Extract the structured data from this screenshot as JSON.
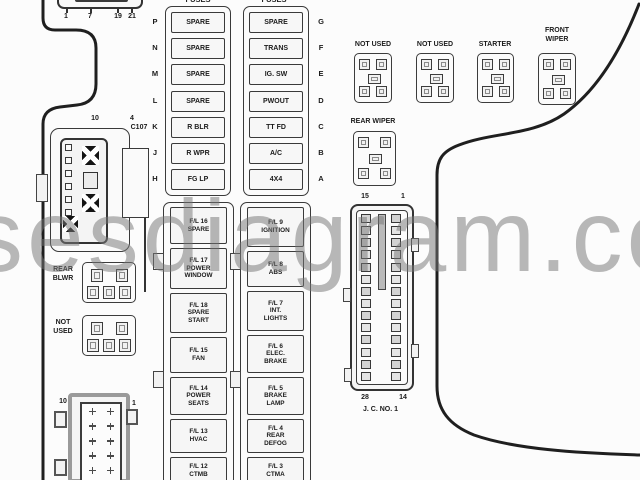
{
  "watermark_text": "sesdiagram.co",
  "top_connector": {
    "pin_labels": [
      "1",
      "7",
      "19",
      "21"
    ]
  },
  "fuse_columns": [
    {
      "header": "FUSES",
      "rows": [
        {
          "letter": "P",
          "label": "SPARE"
        },
        {
          "letter": "N",
          "label": "SPARE"
        },
        {
          "letter": "M",
          "label": "SPARE"
        },
        {
          "letter": "L",
          "label": "SPARE"
        },
        {
          "letter": "K",
          "label": "R BLR"
        },
        {
          "letter": "J",
          "label": "R WPR"
        },
        {
          "letter": "H",
          "label": "FG LP"
        }
      ]
    },
    {
      "header": "FUSES",
      "rows": [
        {
          "letter": "G",
          "label": "SPARE"
        },
        {
          "letter": "F",
          "label": "TRANS"
        },
        {
          "letter": "E",
          "label": "IG. SW"
        },
        {
          "letter": "D",
          "label": "PWOUT"
        },
        {
          "letter": "C",
          "label": "TT FD"
        },
        {
          "letter": "B",
          "label": "A/C"
        },
        {
          "letter": "A",
          "label": "4X4"
        }
      ]
    }
  ],
  "top_relays": [
    {
      "label": "NOT USED"
    },
    {
      "label": "NOT USED"
    },
    {
      "label": "STARTER"
    },
    {
      "label": "FRONT\nWIPER"
    }
  ],
  "rear_wiper_relay": {
    "label": "REAR WIPER"
  },
  "side_relays": [
    {
      "label": "REAR\nBLWR"
    },
    {
      "label": "NOT\nUSED"
    }
  ],
  "c107_connector": {
    "label": "C107",
    "pin_left": "10",
    "pin_right": "4"
  },
  "junction_connector": {
    "pin_top_left": "15",
    "pin_top_right": "1",
    "pin_bottom_left": "28",
    "pin_bottom_right": "14",
    "label": "J. C. NO. 1"
  },
  "bottom_connector": {
    "pin_left": "10",
    "pin_right": "1"
  },
  "fusible_link_columns": [
    {
      "boxes": [
        "F/L 16\nSPARE",
        "F/L 17\nPOWER\nWINDOW",
        "F/L 18\nSPARE\nSTART",
        "F/L 15\nFAN",
        "F/L 14\nPOWER\nSEATS",
        "F/L 13\nHVAC",
        "F/L 12\nCTMB"
      ]
    },
    {
      "boxes": [
        "F/L 9\nIGNITION",
        "F/L 8\nABS",
        "F/L 7\nINT.\nLIGHTS",
        "F/L 6\nELEC.\nBRAKE",
        "F/L 5\nBRAKE\nLAMP",
        "F/L 4\nREAR\nDEFOG",
        "F/L 3\nCTMA"
      ]
    }
  ]
}
